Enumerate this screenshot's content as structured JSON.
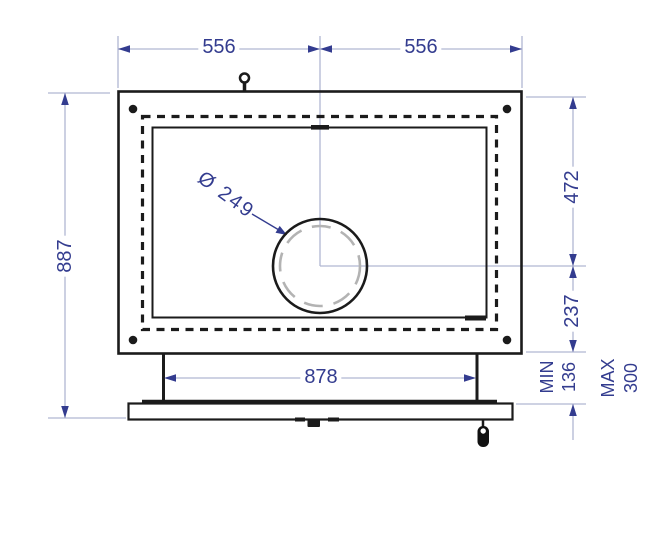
{
  "dimensions": {
    "top_left_width": "556",
    "top_right_width": "556",
    "overall_height": "887",
    "upper_right_depth": "472",
    "lower_right_depth": "237",
    "base_width": "878",
    "min_label": "MIN",
    "min_value": "136",
    "max_label": "MAX",
    "max_value": "300",
    "flue_diameter": "Ø 249"
  },
  "colors": {
    "dimension_text": "#333c8f",
    "dimension_line": "#b1b6d2",
    "drawing_line": "#1b1b1b",
    "hidden_detail_dash": "#b3b3b3"
  }
}
